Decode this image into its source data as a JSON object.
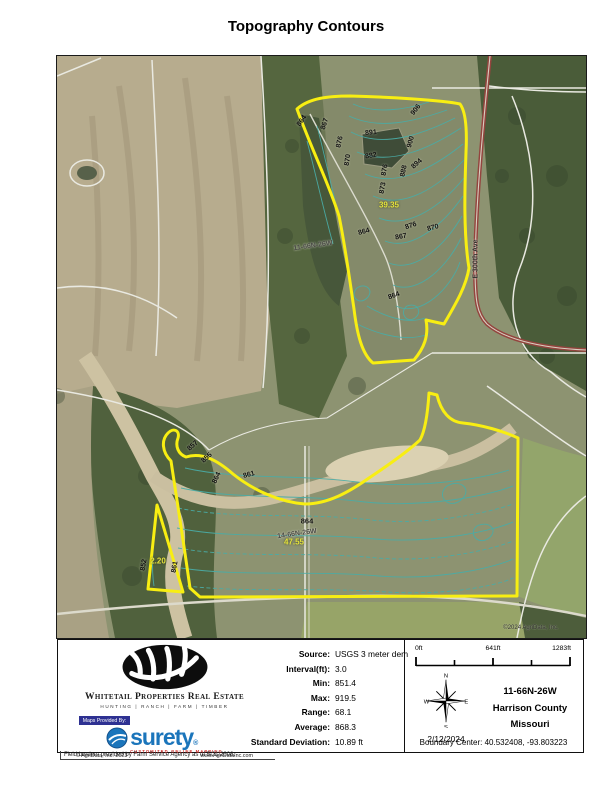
{
  "title": "Topography Contours",
  "map": {
    "watermark": "©2024 AgriData, Inc.",
    "road_label": "E 300th Ave",
    "sections": [
      "11-66N-26W",
      "14-66N-26W"
    ],
    "acres": [
      "39.35",
      "47.55",
      "2.20"
    ],
    "elev": [
      "864",
      "867",
      "876",
      "870",
      "891",
      "882",
      "876",
      "873",
      "906",
      "900",
      "894",
      "888",
      "876",
      "870",
      "867",
      "864",
      "864",
      "857",
      "855",
      "864",
      "861",
      "864",
      "852",
      "861"
    ],
    "colors": {
      "boundary": "#f8ee12",
      "contour": "#4aaca6",
      "acre_label": "#e3e23c",
      "road": "#94443e"
    }
  },
  "branding": {
    "company": "Whitetail Properties Real Estate",
    "tagline": "HUNTING | RANCH | FARM | TIMBER",
    "maps_provided_by": "Maps Provided By:",
    "surety": "surety",
    "surety_reg": "®",
    "surety_tagline": "CUSTOMIZED ONLINE MAPPING",
    "agridata_copyright": "© AgriData, Inc. 2023",
    "agridata_url": "www.AgriDataInc.com"
  },
  "stats": {
    "rows": [
      {
        "label": "Source:",
        "value": "USGS 3 meter dem"
      },
      {
        "label": "Interval(ft):",
        "value": "3.0"
      },
      {
        "label": "Min:",
        "value": "851.4"
      },
      {
        "label": "Max:",
        "value": "919.5"
      },
      {
        "label": "Range:",
        "value": "68.1"
      },
      {
        "label": "Average:",
        "value": "868.3"
      },
      {
        "label": "Standard Deviation:",
        "value": "10.89 ft"
      }
    ]
  },
  "scale": {
    "ticks": [
      "0ft",
      "641ft",
      "1283ft"
    ]
  },
  "compass": {
    "n": "N",
    "s": "S",
    "e": "E",
    "w": "W",
    "date": "2/12/2024"
  },
  "location": {
    "township": "11-66N-26W",
    "county": "Harrison County",
    "state": "Missouri",
    "boundary_center": "Boundary Center: 40.532408, -93.803223"
  },
  "footer": "Field borders provided by Farm Service Agency as of 5/21/2008."
}
